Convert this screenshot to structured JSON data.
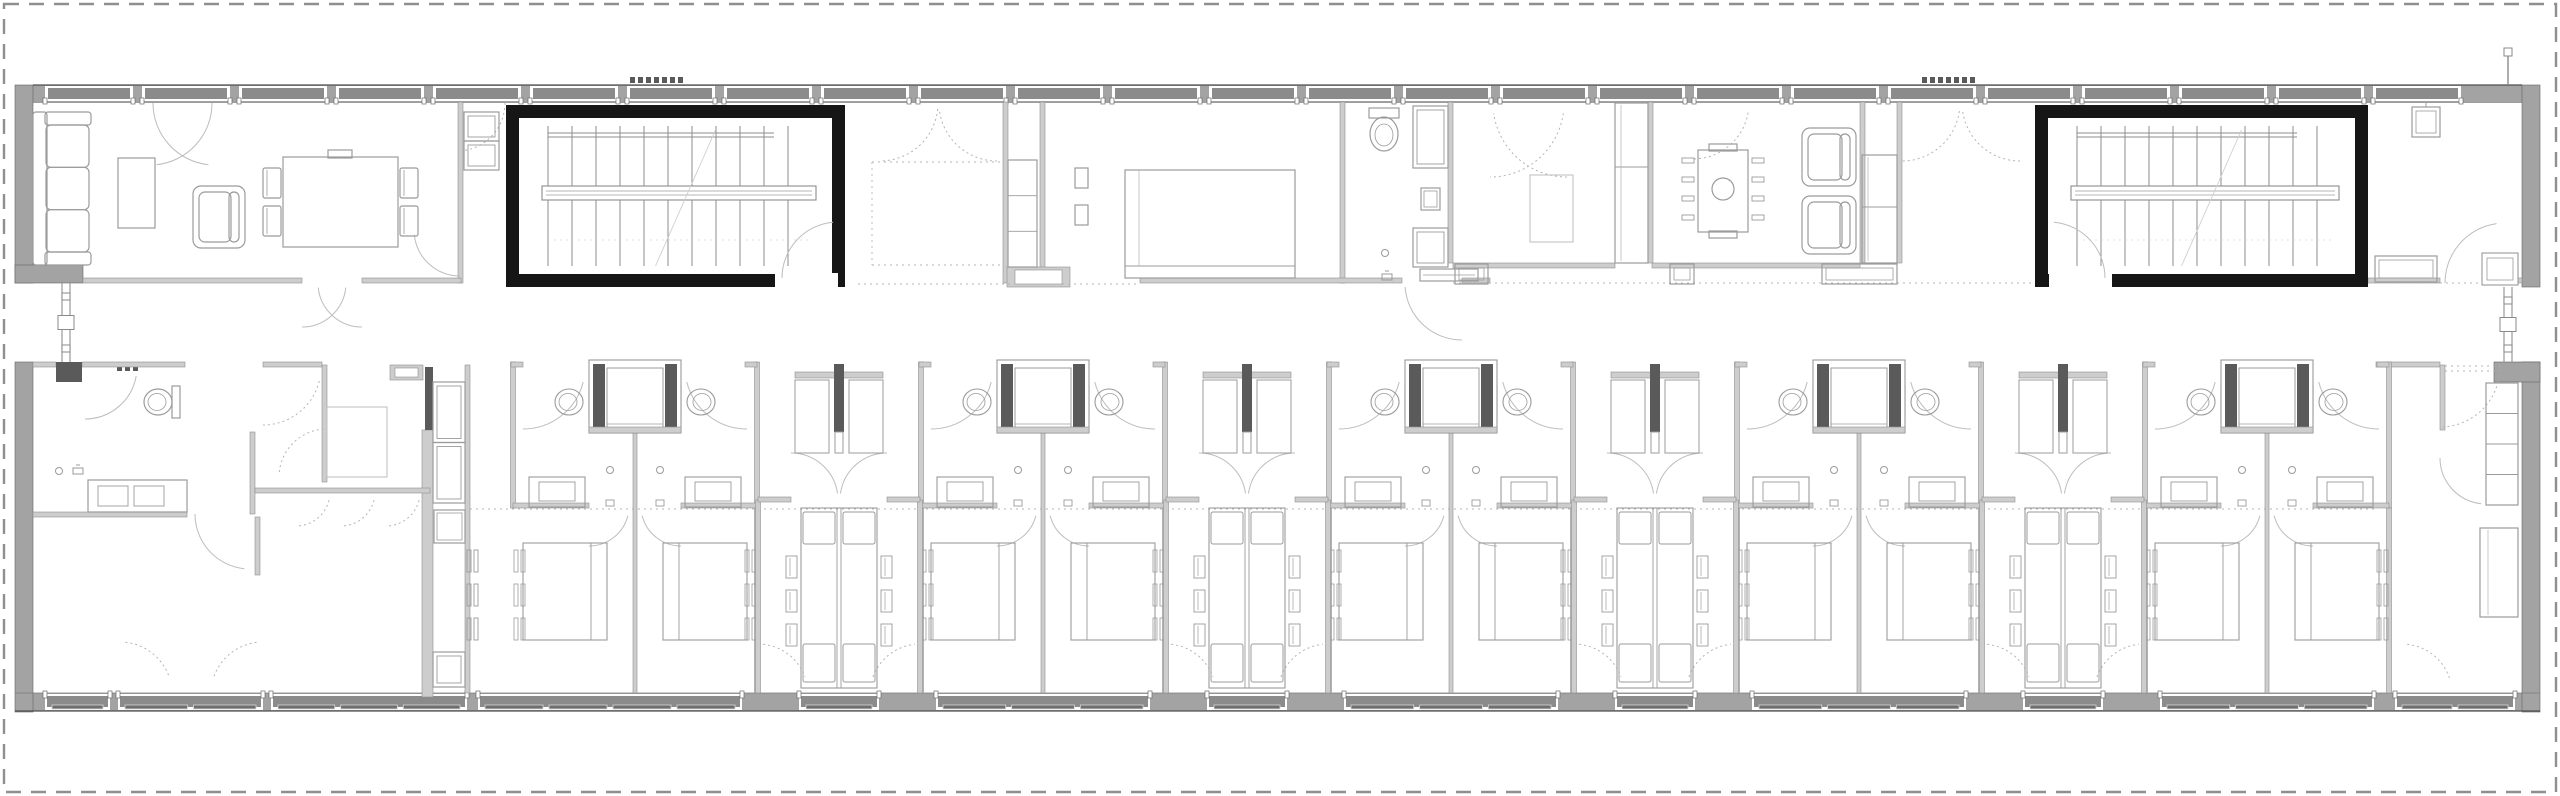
{
  "meta": {
    "type": "architectural-floor-plan",
    "description": "Long residential bar building floor plan: communal rooms and two stair cores on the north band, repeated bedroom pairs with bathrooms and shared study tables on the south band, central corridor, dashed site boundary."
  },
  "canvas": {
    "w": 2560,
    "h": 796
  },
  "colors": {
    "bg": "#ffffff",
    "boundary": "#8f8f8f",
    "ext_wall": "#a3a3a3",
    "ext_stroke": "#636363",
    "glass": "#8b8b8b",
    "frame": "#ffffff",
    "sill": "#4f4f4f",
    "int_wall": "#cdcdcd",
    "int_stroke": "#8f8f8f",
    "black": "#161616",
    "line": "#9b9b9b",
    "line_light": "#bdbdbd",
    "dark_bit": "#5a5a5a",
    "dotted": "#b4b4b4"
  },
  "boundary": {
    "inset": 4,
    "dash": "15,10",
    "width": 2.4
  },
  "building": {
    "top_wall": {
      "x": 33,
      "y": 85,
      "x2": 2522,
      "y2": 102
    },
    "bottom_wall": {
      "x": 15,
      "y": 693,
      "x2": 2540,
      "y2": 711
    },
    "top_band_y2": 283,
    "corridor_y2": 362
  },
  "walls_ext": [
    [
      15,
      85,
      18,
      198
    ],
    [
      15,
      265,
      68,
      18
    ],
    [
      15,
      362,
      18,
      350
    ],
    [
      2522,
      85,
      18,
      202
    ],
    [
      2522,
      362,
      18,
      350
    ],
    [
      2494,
      362,
      46,
      20
    ]
  ],
  "top_windows": {
    "start": 45,
    "end": 2518,
    "unit": 88,
    "pier": 9
  },
  "bottom_windows": {
    "segments": [
      [
        45,
        110
      ],
      [
        118,
        263
      ],
      [
        271,
        467
      ],
      [
        478,
        742
      ],
      [
        799,
        879
      ],
      [
        936,
        1150
      ],
      [
        1207,
        1287
      ],
      [
        1344,
        1558
      ],
      [
        1615,
        1695
      ],
      [
        1752,
        1966
      ],
      [
        2023,
        2103
      ],
      [
        2160,
        2374
      ],
      [
        2395,
        2515
      ]
    ]
  },
  "stairwells": [
    {
      "name": "stairwell-west",
      "x": 506,
      "y": 105,
      "w": 339,
      "h": 182,
      "wall": 13,
      "door": {
        "x": 775,
        "w": 63,
        "side": "e"
      }
    },
    {
      "name": "stairwell-east",
      "x": 2035,
      "y": 105,
      "w": 333,
      "h": 182,
      "wall": 13,
      "door": {
        "x": 2049,
        "w": 63,
        "side": "w"
      }
    }
  ],
  "links": [
    {
      "name": "link-west",
      "x": 66,
      "y1": 283,
      "y2": 362
    },
    {
      "name": "link-east",
      "x": 2508,
      "y1": 287,
      "y2": 362
    }
  ],
  "pipe_east": {
    "x": 2508,
    "y1": 48,
    "y2": 85
  },
  "entrance_dashes": [
    {
      "x": 630,
      "y": 77,
      "n": 7
    },
    {
      "x": 1922,
      "y": 77,
      "n": 7
    }
  ],
  "entry_dots": {
    "x": 117,
    "y": 366
  },
  "walls_int": [
    [
      458,
      102,
      5,
      181
    ],
    [
      83,
      278,
      219,
      5
    ],
    [
      362,
      278,
      99,
      5
    ],
    [
      1040,
      102,
      5,
      181
    ],
    [
      1003,
      102,
      5,
      181
    ],
    [
      1340,
      102,
      5,
      181
    ],
    [
      1140,
      278,
      262,
      5
    ],
    [
      1448,
      102,
      5,
      161
    ],
    [
      1462,
      278,
      28,
      5
    ],
    [
      1453,
      263,
      162,
      5
    ],
    [
      1648,
      102,
      5,
      161
    ],
    [
      1652,
      263,
      208,
      5
    ],
    [
      1860,
      102,
      5,
      161
    ],
    [
      1897,
      102,
      5,
      161
    ],
    [
      2368,
      278,
      72,
      5
    ],
    [
      2505,
      278,
      17,
      5
    ],
    [
      33,
      362,
      23,
      5
    ],
    [
      82,
      362,
      103,
      5
    ],
    [
      263,
      362,
      59,
      5
    ],
    [
      322,
      365,
      5,
      117
    ],
    [
      390,
      365,
      33,
      15
    ],
    [
      422,
      430,
      11,
      267
    ],
    [
      250,
      432,
      5,
      82
    ],
    [
      33,
      512,
      154,
      5
    ],
    [
      255,
      488,
      175,
      5
    ],
    [
      255,
      517,
      5,
      58
    ],
    [
      465,
      365,
      5,
      328
    ],
    [
      2376,
      362,
      64,
      5
    ],
    [
      2440,
      365,
      5,
      65
    ],
    [
      1007,
      267,
      63,
      20
    ]
  ],
  "dark_bits": [
    [
      425,
      367,
      8,
      63
    ],
    [
      56,
      362,
      26,
      20
    ]
  ],
  "dotted_lines": [
    [
      858,
      284,
      1140,
      284
    ],
    [
      1453,
      283,
      2035,
      283
    ],
    [
      2368,
      283,
      2505,
      283
    ],
    [
      470,
      509,
      2376,
      509
    ],
    [
      2445,
      366,
      2500,
      366
    ],
    [
      2445,
      371,
      2500,
      371
    ],
    [
      872,
      162,
      1003,
      162
    ],
    [
      872,
      162,
      872,
      265
    ],
    [
      872,
      265,
      1003,
      265
    ],
    [
      1003,
      162,
      1003,
      265
    ]
  ],
  "doors": [
    [
      150,
      103,
      62,
      0,
      84,
      0
    ],
    [
      215,
      103,
      62,
      96,
      180,
      0
    ],
    [
      457,
      103,
      48,
      0,
      84,
      1
    ],
    [
      880,
      103,
      58,
      6,
      90,
      1
    ],
    [
      997,
      103,
      58,
      90,
      174,
      1
    ],
    [
      1490,
      103,
      74,
      8,
      90,
      1
    ],
    [
      1567,
      103,
      74,
      90,
      172,
      1
    ],
    [
      1693,
      103,
      56,
      10,
      90,
      1
    ],
    [
      1902,
      103,
      58,
      8,
      90,
      1
    ],
    [
      2020,
      103,
      58,
      90,
      172,
      1
    ],
    [
      1462,
      283,
      57,
      90,
      176,
      0
    ],
    [
      302,
      283,
      44,
      6,
      90,
      0
    ],
    [
      362,
      283,
      44,
      90,
      174,
      0
    ],
    [
      460,
      230,
      46,
      90,
      174,
      0
    ],
    [
      2505,
      283,
      60,
      180,
      262,
      0
    ],
    [
      838,
      278,
      56,
      180,
      265,
      0
    ],
    [
      2049,
      278,
      56,
      275,
      360,
      0
    ],
    [
      85,
      367,
      52,
      10,
      90,
      0
    ],
    [
      263,
      367,
      58,
      14,
      90,
      1
    ],
    [
      250,
      514,
      55,
      96,
      180,
      0
    ],
    [
      327,
      477,
      48,
      186,
      268,
      1
    ],
    [
      296,
      492,
      34,
      14,
      90,
      1
    ],
    [
      341,
      492,
      34,
      14,
      90,
      1
    ],
    [
      386,
      492,
      34,
      14,
      90,
      1
    ],
    [
      120,
      694,
      52,
      276,
      340,
      1
    ],
    [
      263,
      694,
      52,
      200,
      264,
      1
    ],
    [
      2440,
      367,
      60,
      14,
      90,
      1
    ],
    [
      2486,
      458,
      46,
      96,
      180,
      0
    ],
    [
      2402,
      694,
      50,
      276,
      344,
      1
    ]
  ],
  "furniture": [
    {
      "t": "sofa3",
      "name": "sofa",
      "x": 33,
      "y": 112,
      "w": 58,
      "h": 153
    },
    {
      "t": "table",
      "name": "coffee-table",
      "x": 118,
      "y": 158,
      "w": 37,
      "h": 70
    },
    {
      "t": "armchair",
      "name": "armchair",
      "x": 193,
      "y": 186,
      "w": 52,
      "h": 62,
      "back": "e"
    },
    {
      "t": "dining6",
      "name": "dining-table",
      "x": 283,
      "y": 157,
      "w": 115,
      "h": 90
    },
    {
      "t": "cabstack",
      "name": "cabinet",
      "x": 464,
      "y": 112,
      "w": 35,
      "h": 58,
      "n": 2
    },
    {
      "t": "closetcol",
      "name": "closet",
      "x": 1008,
      "y": 160,
      "w": 29,
      "h": 107,
      "divs": 2
    },
    {
      "t": "shelves2",
      "name": "wall-shelves",
      "x": 1075,
      "y": 168
    },
    {
      "t": "bedtop",
      "name": "double-bed",
      "x": 1125,
      "y": 170,
      "w": 170,
      "h": 108
    },
    {
      "t": "toiletdown",
      "name": "toilet",
      "cx": 1384,
      "cy": 130
    },
    {
      "t": "drain",
      "name": "shower-drain",
      "cx": 1385,
      "cy": 253
    },
    {
      "t": "showerfix",
      "name": "shower-fixture",
      "cx": 1387,
      "cy": 277
    },
    {
      "t": "cabstack",
      "name": "tall-cabinet",
      "x": 1413,
      "y": 106,
      "w": 35,
      "h": 62,
      "n": 1
    },
    {
      "t": "miniap",
      "name": "appliance",
      "x": 1421,
      "y": 188,
      "w": 19,
      "h": 22
    },
    {
      "t": "cabstack",
      "name": "tall-cabinet",
      "x": 1413,
      "y": 228,
      "w": 35,
      "h": 39,
      "n": 1
    },
    {
      "t": "leafbar",
      "name": "door-leaf",
      "x": 1420,
      "y": 269,
      "w": 58,
      "h": 12
    },
    {
      "t": "rug",
      "name": "rug",
      "x": 1530,
      "y": 175,
      "w": 43,
      "h": 67
    },
    {
      "t": "wardcol2",
      "name": "wardrobe",
      "x": 1615,
      "y": 103,
      "w": 33,
      "h": 160,
      "div": 64
    },
    {
      "t": "conftable",
      "name": "meeting-table",
      "x": 1698,
      "y": 150,
      "w": 50,
      "h": 82
    },
    {
      "t": "armchair",
      "name": "armchair",
      "x": 1802,
      "y": 128,
      "w": 54,
      "h": 58,
      "back": "e"
    },
    {
      "t": "armchair",
      "name": "armchair",
      "x": 1802,
      "y": 196,
      "w": 54,
      "h": 58,
      "back": "e"
    },
    {
      "t": "wardcol2",
      "name": "wardrobe",
      "x": 1862,
      "y": 155,
      "w": 35,
      "h": 108,
      "div": 52
    },
    {
      "t": "bench",
      "name": "bench",
      "x": 1455,
      "y": 264,
      "w": 33,
      "h": 20
    },
    {
      "t": "bench",
      "name": "bench",
      "x": 1670,
      "y": 264,
      "w": 24,
      "h": 20
    },
    {
      "t": "bench",
      "name": "bench",
      "x": 1822,
      "y": 264,
      "w": 75,
      "h": 20
    },
    {
      "t": "shaftsq",
      "name": "duct",
      "x": 2412,
      "y": 107,
      "w": 28,
      "h": 30
    },
    {
      "t": "bench",
      "name": "bench",
      "x": 2375,
      "y": 256,
      "w": 62,
      "h": 26
    },
    {
      "t": "niche",
      "name": "niche",
      "x": 2482,
      "y": 253,
      "w": 36,
      "h": 32
    },
    {
      "t": "toiletside",
      "name": "toilet",
      "cx": 160,
      "cy": 402,
      "back": "e"
    },
    {
      "t": "drain",
      "name": "shower-drain",
      "cx": 59,
      "cy": 471
    },
    {
      "t": "showerfix",
      "name": "shower-fixture",
      "cx": 78,
      "cy": 471
    },
    {
      "t": "vanity2",
      "name": "double-vanity",
      "x": 88,
      "y": 480,
      "w": 99,
      "h": 32
    },
    {
      "t": "rug",
      "name": "inner-room",
      "x": 327,
      "y": 407,
      "w": 60,
      "h": 70
    },
    {
      "t": "cabstack",
      "name": "kitchenette",
      "x": 433,
      "y": 382,
      "w": 32,
      "h": 121,
      "n": 2
    },
    {
      "t": "miniap",
      "name": "appliance",
      "x": 434,
      "y": 510,
      "w": 31,
      "h": 33
    },
    {
      "t": "cabstack",
      "name": "kitchenette",
      "x": 433,
      "y": 652,
      "w": 32,
      "h": 35,
      "n": 1
    },
    {
      "t": "strips3",
      "name": "wall-units",
      "x": 467,
      "y": 550
    },
    {
      "t": "closetcol",
      "name": "wardrobe",
      "x": 2486,
      "y": 383,
      "w": 32,
      "h": 122,
      "divs": 3
    },
    {
      "t": "desk",
      "name": "desk",
      "x": 2480,
      "y": 528,
      "w": 38,
      "h": 89
    }
  ],
  "pair_modules": {
    "centers": [
      635,
      1043,
      1451,
      1859,
      2267
    ],
    "half_width": 122,
    "bath_y": 362,
    "bath_y2": 508,
    "bed": {
      "w": 84,
      "h": 97,
      "y": 543,
      "pillow_inset": 16
    },
    "skip_west_bedwall": [
      635
    ]
  },
  "spine_modules": {
    "centers": [
      839,
      1247,
      1655,
      2063
    ],
    "half_width": 81,
    "top_y": 500,
    "recess_half": 44
  },
  "rooms": [
    "lounge-west",
    "dining-west",
    "stair-vestibule-west",
    "entrance-hall",
    "bedroom-north",
    "bathroom-north",
    "storage-north",
    "living-room",
    "meeting-room",
    "vestibule-east",
    "room-northeast",
    "corridor",
    "accessible-suite-southwest",
    "bedroom-pairs-south",
    "study-spines-south",
    "suite-southeast"
  ]
}
